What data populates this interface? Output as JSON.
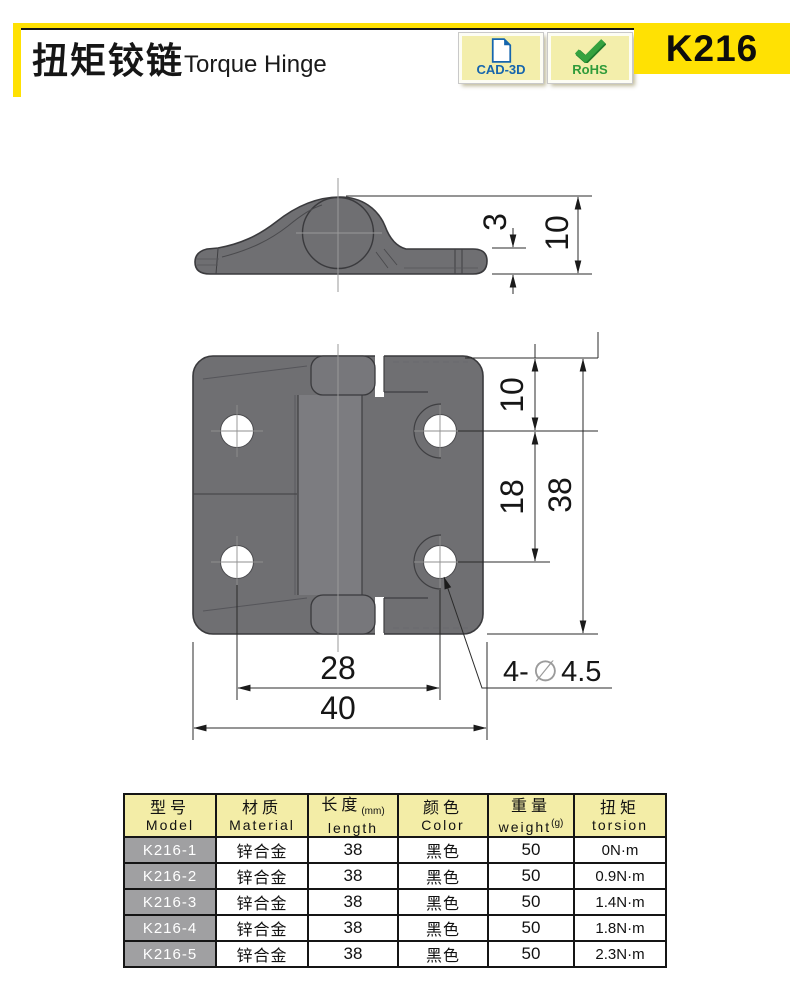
{
  "header": {
    "title_zh": "扭矩铰链",
    "title_en": "Torque Hinge",
    "model_code": "K216",
    "badges": [
      {
        "label": "CAD-3D",
        "icon": "document-icon"
      },
      {
        "label": "RoHS",
        "icon": "checkmark-icon"
      }
    ]
  },
  "colors": {
    "accent_yellow": "#ffe103",
    "badge_cream": "#f3eeab",
    "cad_blue": "#1565ad",
    "rohs_green": "#2f9b3a",
    "table_header_bg": "#f3eda7",
    "model_cell_bg": "#a0a0a2",
    "hinge_gray": "#6f6f72"
  },
  "dimensions": {
    "side": {
      "thickness": "3",
      "height": "10"
    },
    "front": {
      "top_offset": "10",
      "pitch": "18",
      "height": "38",
      "span": "28",
      "width": "40",
      "callout_prefix": "4-",
      "callout_dia": "∅",
      "callout_value": "4.5"
    }
  },
  "table": {
    "headers": [
      {
        "zh": "型号",
        "en": "Model",
        "unit": ""
      },
      {
        "zh": "材质",
        "en": "Material",
        "unit": ""
      },
      {
        "zh": "长度",
        "en": "length",
        "unit": "(mm)"
      },
      {
        "zh": "颜色",
        "en": "Color",
        "unit": ""
      },
      {
        "zh": "重量",
        "en": "weight",
        "unit": "(g)"
      },
      {
        "zh": "扭矩",
        "en": "torsion",
        "unit": ""
      }
    ],
    "rows": [
      {
        "model": "K216-1",
        "material": "锌合金",
        "length": "38",
        "color": "黑色",
        "weight": "50",
        "torsion": "0N·m"
      },
      {
        "model": "K216-2",
        "material": "锌合金",
        "length": "38",
        "color": "黑色",
        "weight": "50",
        "torsion": "0.9N·m"
      },
      {
        "model": "K216-3",
        "material": "锌合金",
        "length": "38",
        "color": "黑色",
        "weight": "50",
        "torsion": "1.4N·m"
      },
      {
        "model": "K216-4",
        "material": "锌合金",
        "length": "38",
        "color": "黑色",
        "weight": "50",
        "torsion": "1.8N·m"
      },
      {
        "model": "K216-5",
        "material": "锌合金",
        "length": "38",
        "color": "黑色",
        "weight": "50",
        "torsion": "2.3N·m"
      }
    ]
  }
}
